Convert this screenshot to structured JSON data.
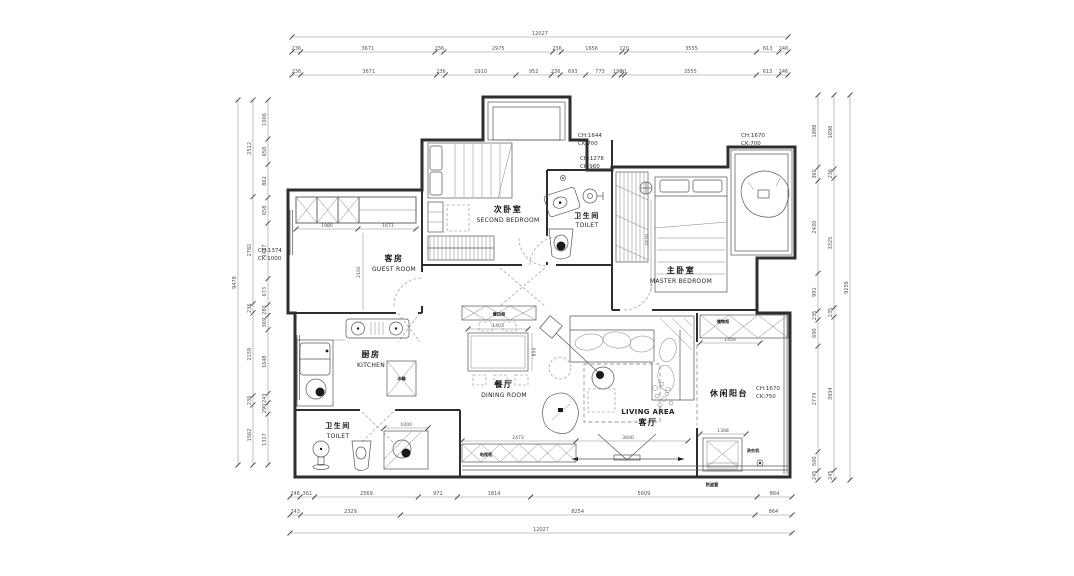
{
  "rooms": {
    "second_bedroom": {
      "zh": "次卧室",
      "en": "SECOND BEDROOM"
    },
    "toilet_upper": {
      "zh": "卫生间",
      "en": "TOILET"
    },
    "master_bedroom": {
      "zh": "主卧室",
      "en": "MASTER BEDROOM"
    },
    "guest_room": {
      "zh": "客房",
      "en": "GUEST ROOM"
    },
    "kitchen": {
      "zh": "厨房",
      "en": "KITCHEN"
    },
    "toilet_lower": {
      "zh": "卫生间",
      "en": "TOILET"
    },
    "dining_room": {
      "zh": "餐厅",
      "en": "DINING ROOM"
    },
    "living_area": {
      "zh": "客厅",
      "en": "LIVING AREA"
    },
    "leisure_balcony": {
      "zh": "休闲阳台"
    }
  },
  "annotations": {
    "left_window": {
      "line1": "CH:1374",
      "line2": "CK:1000"
    },
    "top_window_1": {
      "line1": "CH:1644",
      "line2": "CK:700"
    },
    "top_window_2": {
      "line1": "CH:1278",
      "line2": "CK:960"
    },
    "top_right_window": {
      "line1": "CH:1670",
      "line2": "CK:700"
    },
    "right_window": {
      "line1": "CH:1670",
      "line2": "CK:750"
    },
    "security_window": "防盗窗"
  },
  "fixtures": {
    "fridge": "冰箱",
    "washer_upper": "洗衣机",
    "washer_balcony": "洗衣机",
    "storage_cabinet": "储物柜",
    "tv_cabinet": "电视柜",
    "sideboard": "餐边柜"
  },
  "dimensions": {
    "top_total": [
      "12027"
    ],
    "top_row2": [
      "236",
      "3671",
      "236",
      "2975",
      "236",
      "1656",
      "120",
      "3555",
      "613",
      "246"
    ],
    "top_row3": [
      "236",
      "3671",
      "236",
      "1910",
      "952",
      "236",
      "693",
      "773",
      "190",
      "90",
      "3555",
      "613",
      "246"
    ],
    "bottom_row1": [
      "248",
      "361",
      "2569",
      "971",
      "1814",
      "5609",
      "864"
    ],
    "bottom_row2": [
      "243",
      "2329",
      "8254",
      "864"
    ],
    "bottom_total": [
      "12027"
    ],
    "left_outer": [
      "9478"
    ],
    "left_mid": [
      "2512",
      "2782",
      "236",
      "2159",
      "236",
      "1562"
    ],
    "left_inner": [
      "1006",
      "658",
      "862",
      "658",
      "1437",
      "673",
      "280",
      "369",
      "1648",
      "243",
      "290",
      "1317"
    ],
    "right_inner": [
      "1898",
      "360",
      "2430",
      "991",
      "235",
      "690",
      "2774",
      "500",
      "245"
    ],
    "right_mid": [
      "1898",
      "236",
      "3325",
      "235",
      "3934",
      "245"
    ],
    "right_outer": [
      "9258"
    ],
    "inner": {
      "guest_closet_left": "1980",
      "guest_closet_right": "1671",
      "guest_depth": "2192",
      "dining_table_w": "1403",
      "dining_table_h": "850",
      "tv_cabinet_w": "2473",
      "living_south": "3600",
      "balcony_cabinet": "1450",
      "washer_w": "1308",
      "shower": "1000",
      "master_left": "2430"
    }
  },
  "colors": {
    "wall": "#2e2e2e",
    "furniture_line": "#555555",
    "dim_text": "#555555",
    "background": "#ffffff"
  }
}
